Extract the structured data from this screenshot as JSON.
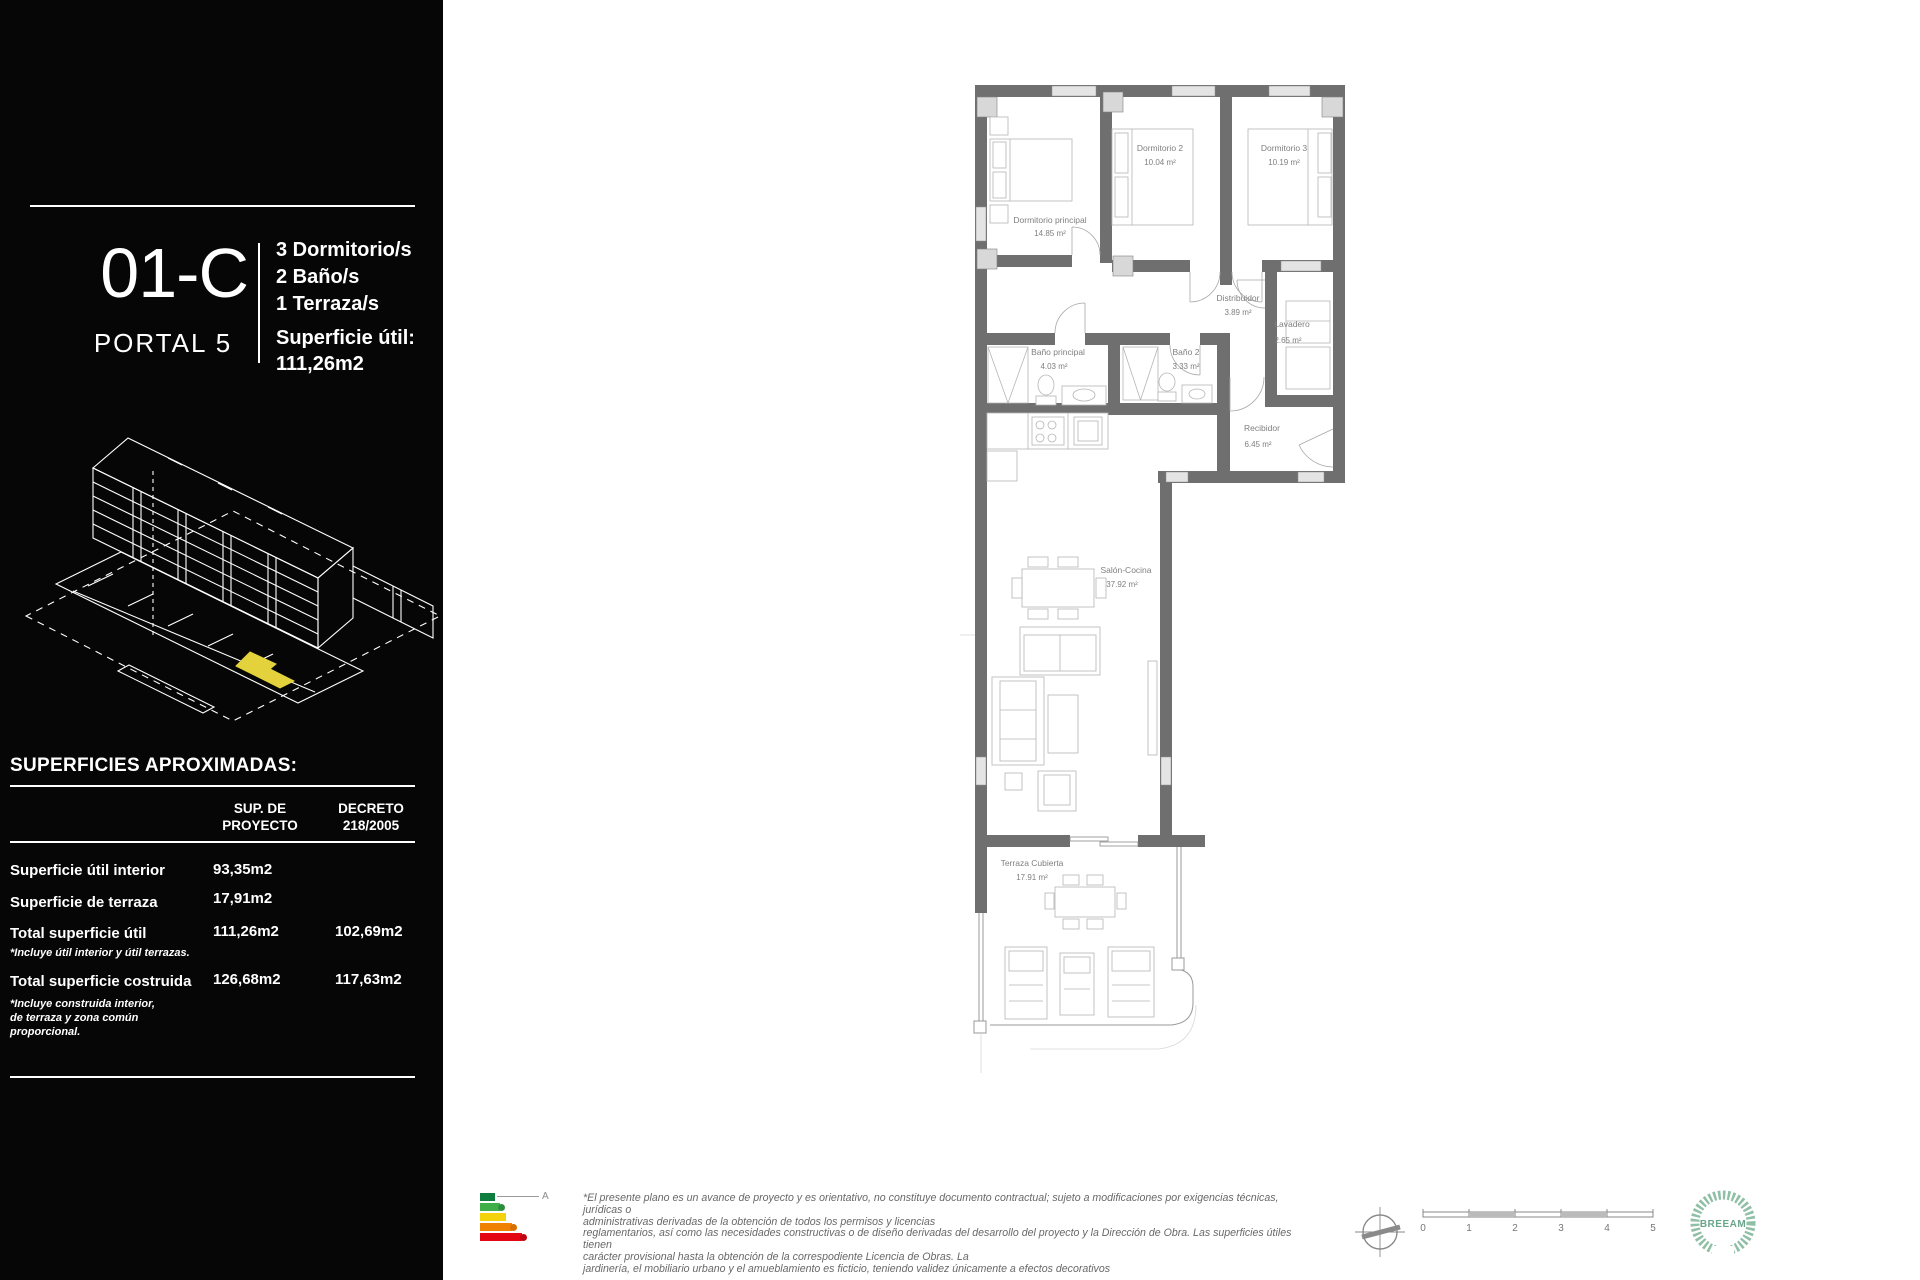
{
  "panel": {
    "unit_code": "01-C",
    "portal": "PORTAL 5",
    "features": [
      "3 Dormitorio/s",
      "2 Baño/s",
      "1 Terraza/s"
    ],
    "area_label": "Superficie útil:",
    "area_value": "111,26m2",
    "table": {
      "title": "SUPERFICIES APROXIMADAS:",
      "col_proyecto_l1": "SUP. DE",
      "col_proyecto_l2": "PROYECTO",
      "col_decreto_l1": "DECRETO",
      "col_decreto_l2": "218/2005",
      "rows": [
        {
          "label": "Superficie útil interior",
          "proyecto": "93,35m2",
          "decreto": ""
        },
        {
          "label": "Superficie de terraza",
          "proyecto": "17,91m2",
          "decreto": ""
        },
        {
          "label": "Total superficie útil",
          "proyecto": "111,26m2",
          "decreto": "102,69m2"
        },
        {
          "label": "Total superficie costruida",
          "proyecto": "126,68m2",
          "decreto": "117,63m2"
        }
      ],
      "note_util": "*Incluye útil interior y útil terrazas.",
      "note_costruida_l1": "*Incluye construida interior,",
      "note_costruida_l2": "de terraza y zona común",
      "note_costruida_l3": "proporcional."
    },
    "highlight_color": "#e3d23b"
  },
  "plan": {
    "rooms": {
      "dormitorio_principal": {
        "name": "Dormitorio principal",
        "area": "14.85 m²"
      },
      "dormitorio_2": {
        "name": "Dormitorio 2",
        "area": "10.04 m²"
      },
      "dormitorio_3": {
        "name": "Dormitorio 3",
        "area": "10.19 m²"
      },
      "distribuidor": {
        "name": "Distribuidor",
        "area": "3.89 m²"
      },
      "lavadero": {
        "name": "Lavadero",
        "area": "2.65 m²"
      },
      "bano_principal": {
        "name": "Baño principal",
        "area": "4.03 m²"
      },
      "bano_2": {
        "name": "Baño 2",
        "area": "3.33 m²"
      },
      "recibidor": {
        "name": "Recibidor",
        "area": "6.45 m²"
      },
      "salon_cocina": {
        "name": "Salón-Cocina",
        "area": "37.92 m²"
      },
      "terraza": {
        "name": "Terraza Cubierta",
        "area": "17.91 m²"
      }
    },
    "wall_color": "#6f6f6f"
  },
  "footer": {
    "energy_grade": "A",
    "energy_colors": [
      "#0e7d3e",
      "#3faf49",
      "#f4d20c",
      "#ef8200",
      "#e30613"
    ],
    "disclaimer": [
      "*El presente plano es un avance de proyecto y es orientativo, no constituye documento contractual; sujeto a modificaciones por exigencias técnicas, jurídicas o",
      "administrativas derivadas de la obtención de todos los permisos y licencias",
      "reglamentarios, así como las necesidades constructivas o de diseño derivadas del desarrollo del proyecto y la Dirección de Obra. Las superficies útiles tienen",
      "carácter provisional hasta la obtención de la correspodiente Licencia de Obras. La",
      "jardinería, el mobiliario urbano y el amueblamiento es ficticio, teniendo validez únicamente a efectos decorativos"
    ],
    "scale_labels": [
      "0",
      "1",
      "2",
      "3",
      "4",
      "5"
    ],
    "breeam_label": "BREEAM"
  }
}
